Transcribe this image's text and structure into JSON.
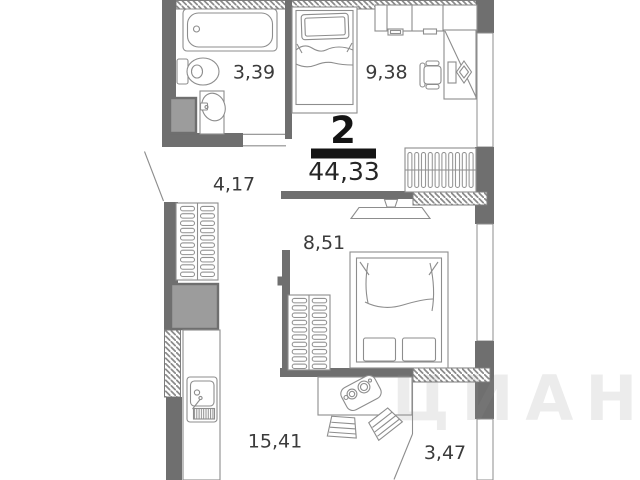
{
  "plan": {
    "summary": {
      "rooms_count": "2",
      "total_area": "44,33"
    },
    "rooms": [
      {
        "id": "bathroom",
        "area": "3,39"
      },
      {
        "id": "bedroom",
        "area": "9,38"
      },
      {
        "id": "hallway",
        "area": "4,17"
      },
      {
        "id": "bedroom-second",
        "area": "8,51"
      },
      {
        "id": "kitchen-living",
        "area": "15,41"
      },
      {
        "id": "balcony",
        "area": "3,47"
      }
    ],
    "watermark": "ЦИАН",
    "colors": {
      "wall": "#6f6f6f",
      "furniture_line": "#8d8d8d",
      "label_text": "#3b3b3b",
      "summary_text": "#141414"
    }
  }
}
